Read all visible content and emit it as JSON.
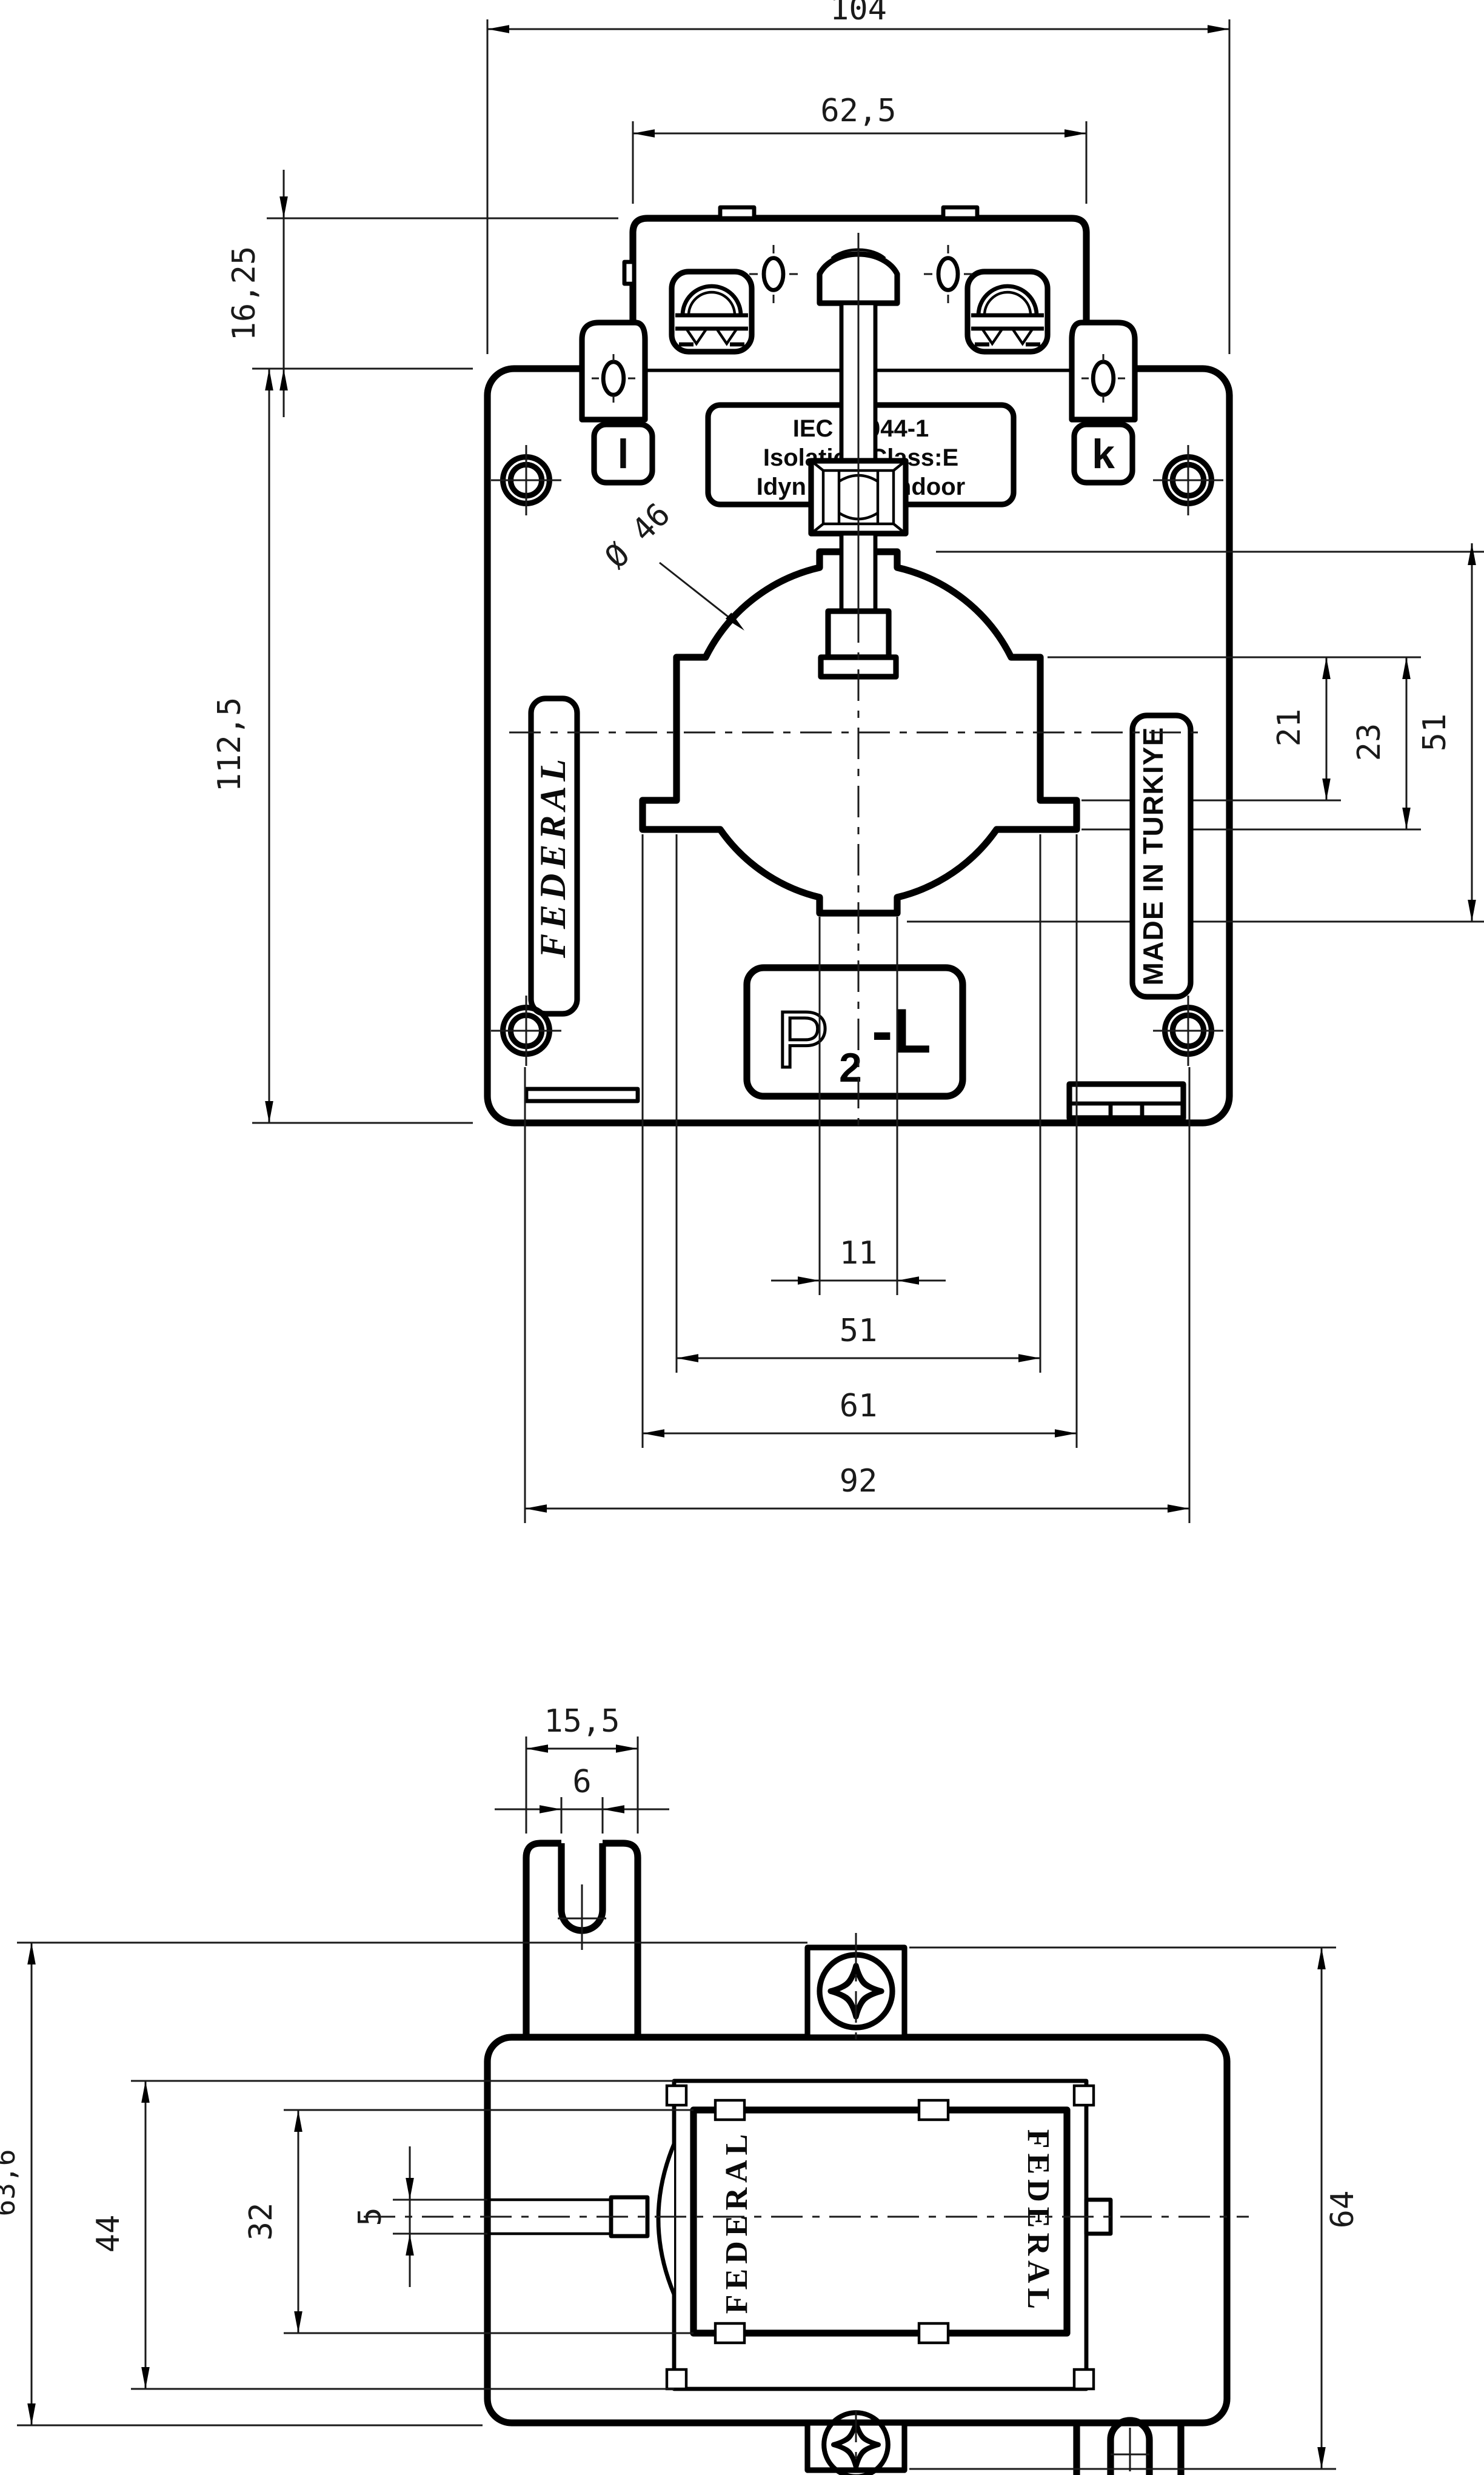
{
  "front_view": {
    "dims": {
      "overall_width": "104",
      "bracket_width": "62,5",
      "bracket_height": "16,25",
      "body_height": "112,5",
      "window_diameter": "Ø 46",
      "window_upper": "21",
      "window_lower": "23",
      "window_side": "51",
      "notch_width": "11",
      "window_width": "51",
      "step_width": "61",
      "hole_spacing": "92"
    },
    "labels": {
      "brand": "FEDERAL",
      "origin": "MADE IN TURKIYE",
      "terminal_left": "l",
      "terminal_right": "k",
      "plate_line1": "IEC 60044-1",
      "plate_line2": "Isolation Class:E",
      "plate_line3": "Idyn:2.5xIn Indoor",
      "polarity_p": "P",
      "polarity_sub": "2",
      "polarity_tail": "-L"
    }
  },
  "bottom_view": {
    "dims": {
      "tab_width": "15,5",
      "slot_width": "6",
      "overall_height": "63,6",
      "frame_height": "44",
      "window_height": "32",
      "blade_thickness": "5",
      "body_height": "64"
    },
    "labels": {
      "brand_left": "FEDERAL",
      "brand_right": "FEDERAL"
    }
  }
}
